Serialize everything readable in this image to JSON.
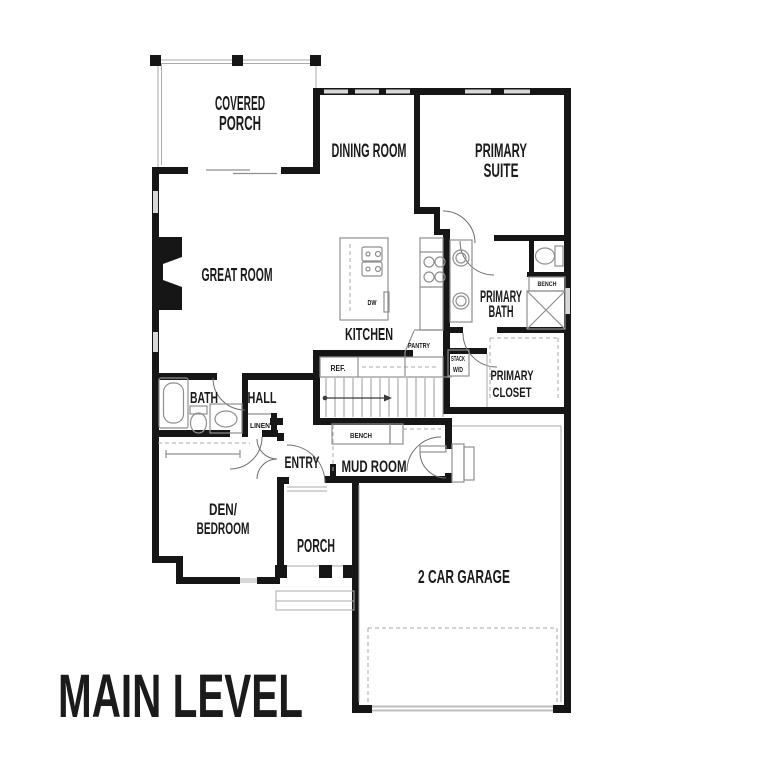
{
  "title": "MAIN LEVEL",
  "colors": {
    "wall": "#161616",
    "window_glass": "#d8d8d8",
    "fixture_line": "#8f8f8f",
    "text": "#1b1b1b"
  },
  "rooms": {
    "covered_porch": {
      "line1": "COVERED",
      "line2": "PORCH"
    },
    "dining_room": {
      "label": "DINING ROOM"
    },
    "primary_suite": {
      "line1": "PRIMARY",
      "line2": "SUITE"
    },
    "great_room": {
      "label": "GREAT ROOM"
    },
    "kitchen": {
      "label": "KITCHEN"
    },
    "primary_bath": {
      "line1": "PRIMARY",
      "line2": "BATH"
    },
    "primary_closet": {
      "line1": "PRIMARY",
      "line2": "CLOSET"
    },
    "bath": {
      "label": "BATH"
    },
    "hall": {
      "label": "HALL"
    },
    "entry": {
      "label": "ENTRY"
    },
    "mud_room": {
      "label": "MUD ROOM"
    },
    "den_bedroom": {
      "line1": "DEN/",
      "line2": "BEDROOM"
    },
    "porch": {
      "label": "PORCH"
    },
    "garage": {
      "label": "2 CAR GARAGE"
    }
  },
  "fixtures": {
    "linen": "LINEN",
    "pantry": "PANTRY",
    "refrigerator": "REF.",
    "dishwasher": "DW",
    "stack_washer_dryer_line1": "STACK",
    "stack_washer_dryer_line2": "W/D",
    "bath_bench": "BENCH",
    "mud_bench": "BENCH"
  }
}
